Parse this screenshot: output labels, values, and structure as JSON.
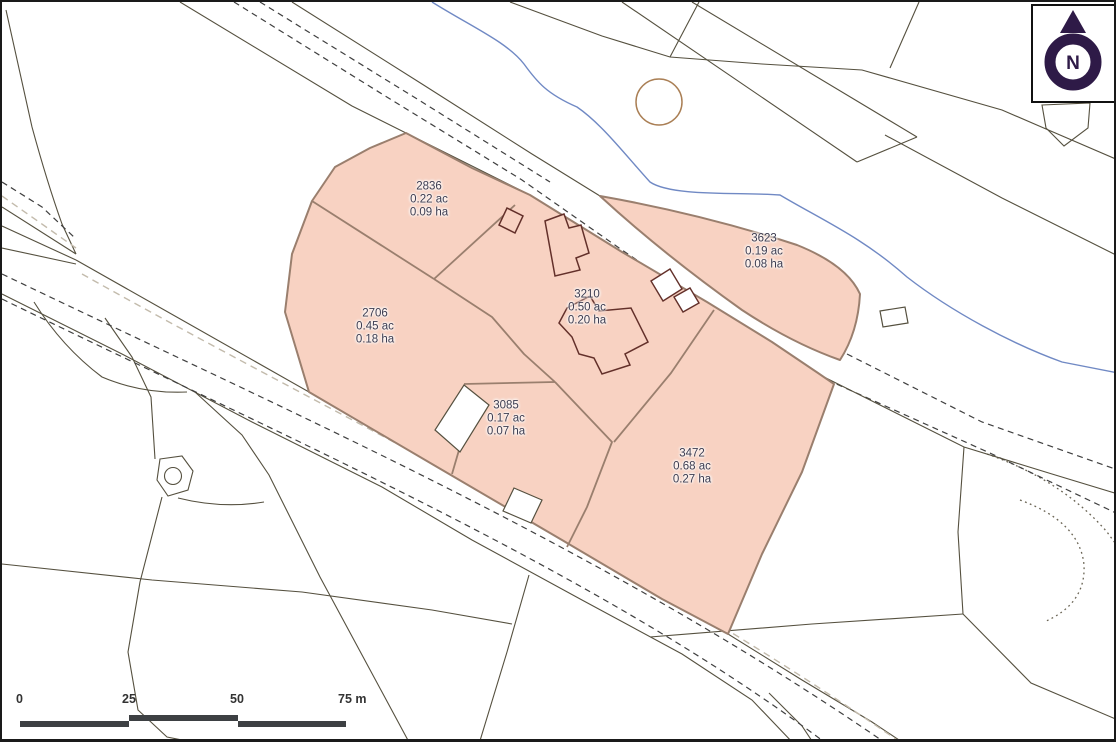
{
  "parcels": [
    {
      "id": "2836",
      "acres": "0.22 ac",
      "hectares": "0.09 ha"
    },
    {
      "id": "3623",
      "acres": "0.19 ac",
      "hectares": "0.08 ha"
    },
    {
      "id": "2706",
      "acres": "0.45 ac",
      "hectares": "0.18 ha"
    },
    {
      "id": "3210",
      "acres": "0.50 ac",
      "hectares": "0.20 ha"
    },
    {
      "id": "3085",
      "acres": "0.17 ac",
      "hectares": "0.07 ha"
    },
    {
      "id": "3472",
      "acres": "0.68 ac",
      "hectares": "0.27 ha"
    }
  ],
  "scale_bar": {
    "ticks": [
      "0",
      "25",
      "50",
      "75 m"
    ]
  },
  "north_arrow": {
    "label": "N"
  },
  "colors": {
    "parcel_fill": "#f8d2c2",
    "parcel_border": "#9a7f6e",
    "building_outline": "#63302a",
    "water": "#7089c4",
    "field_line": "#55503f",
    "road_dash": "#3f3f3f",
    "road_dash_light": "#c3bbac",
    "tree_ring": "#aa7f55",
    "north_symbol": "#2e1a47",
    "label_text": "#3c3c50",
    "scale_bar": "#3d4043",
    "frame": "#1a1a1a"
  }
}
